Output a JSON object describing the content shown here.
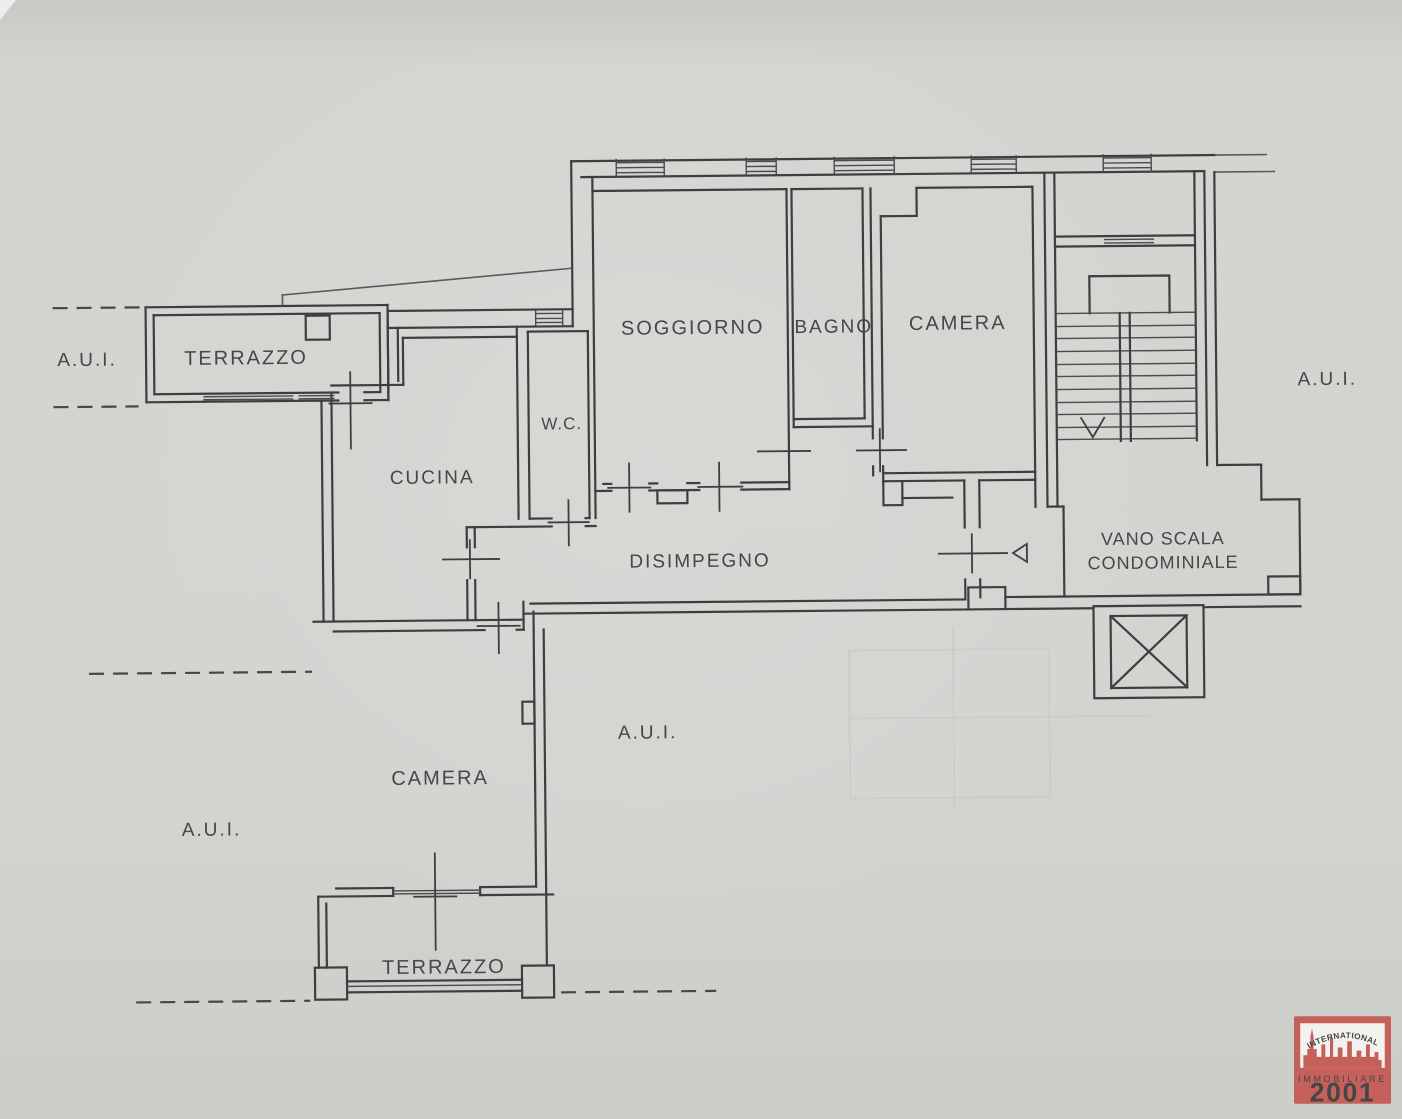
{
  "plan": {
    "rooms": {
      "terrazzo_top": "TERRAZZO",
      "cucina": "CUCINA",
      "wc": "W.C.",
      "soggiorno": "SOGGIORNO",
      "bagno": "BAGNO",
      "camera_top": "CAMERA",
      "disimpegno": "DISIMPEGNO",
      "vano_scala_line1": "VANO SCALA",
      "vano_scala_line2": "CONDOMINIALE",
      "camera_bottom": "CAMERA",
      "terrazzo_bottom": "TERRAZZO"
    },
    "annotations": {
      "aui_top_left": "A.U.I.",
      "aui_right": "A.U.I.",
      "aui_center": "A.U.I.",
      "aui_bottom_left": "A.U.I."
    },
    "colors": {
      "paper": "#d2d4d0",
      "ink": "#3d3e41"
    }
  },
  "logo": {
    "arc_text": "INTERNATIONAL",
    "brand_line": "IMMOBILIARE",
    "brand_number": "2001",
    "colors": {
      "red": "#c5615a",
      "dark_red": "#8e3a36",
      "white": "#f4f2ee"
    }
  }
}
